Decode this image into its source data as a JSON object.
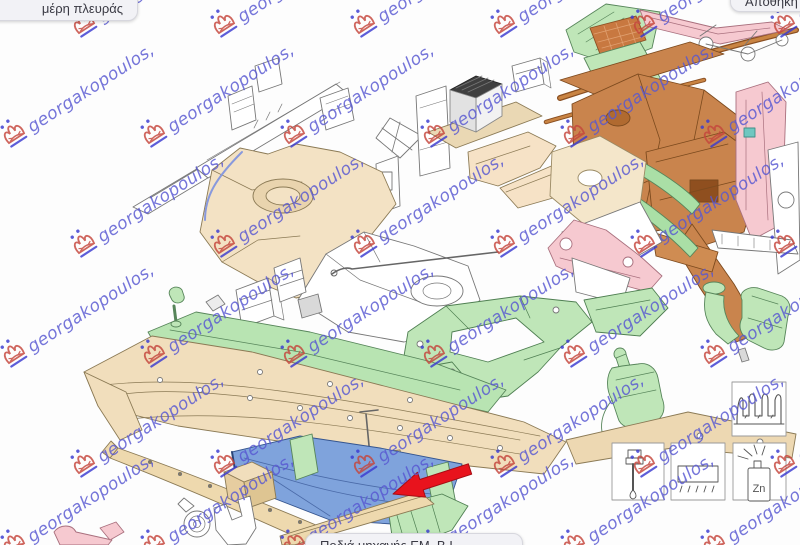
{
  "window": {
    "width": 800,
    "height": 545,
    "background": "#fdfdfd"
  },
  "tooltips": {
    "top_left": "μέρη πλευράς",
    "top_right": "Αποθήκη",
    "bottom": "Ποδιά μηχανής ΕΜ. Β.Ι."
  },
  "watermark": {
    "text": "georgakopoulos,",
    "text_color": "#5757d2",
    "logo_color": "#c5463c",
    "accent_color": "#3b3bd0",
    "angle_deg": -33,
    "positions": [
      [
        80,
        12
      ],
      [
        220,
        12
      ],
      [
        360,
        12
      ],
      [
        500,
        12
      ],
      [
        640,
        12
      ],
      [
        780,
        12
      ],
      [
        10,
        122
      ],
      [
        150,
        122
      ],
      [
        290,
        122
      ],
      [
        430,
        122
      ],
      [
        570,
        122
      ],
      [
        710,
        122
      ],
      [
        80,
        232
      ],
      [
        220,
        232
      ],
      [
        360,
        232
      ],
      [
        500,
        232
      ],
      [
        640,
        232
      ],
      [
        780,
        232
      ],
      [
        10,
        342
      ],
      [
        150,
        342
      ],
      [
        290,
        342
      ],
      [
        430,
        342
      ],
      [
        570,
        342
      ],
      [
        710,
        342
      ],
      [
        80,
        452
      ],
      [
        220,
        452
      ],
      [
        360,
        452
      ],
      [
        500,
        452
      ],
      [
        640,
        452
      ],
      [
        780,
        452
      ],
      [
        10,
        532
      ],
      [
        150,
        532
      ],
      [
        290,
        532
      ],
      [
        430,
        532
      ],
      [
        570,
        532
      ],
      [
        710,
        532
      ]
    ]
  },
  "annotation": {
    "arrow_color": "#e8131d",
    "highlighted_part_color": "#7fa3dc"
  },
  "legend": {
    "zn_label": "Zn",
    "icons": [
      "section-profile",
      "sealant-applicator",
      "trim-strip",
      "zinc-spray-can"
    ]
  },
  "palette": {
    "part_tan": "#f1debc",
    "part_beige": "#f3e2c4",
    "part_sienna": "#c9844d",
    "part_pink": "#f6c9d0",
    "part_green": "#bfe6b8",
    "part_blue": "#7fa3dc",
    "part_white": "#ffffff",
    "outline": "#777777"
  }
}
